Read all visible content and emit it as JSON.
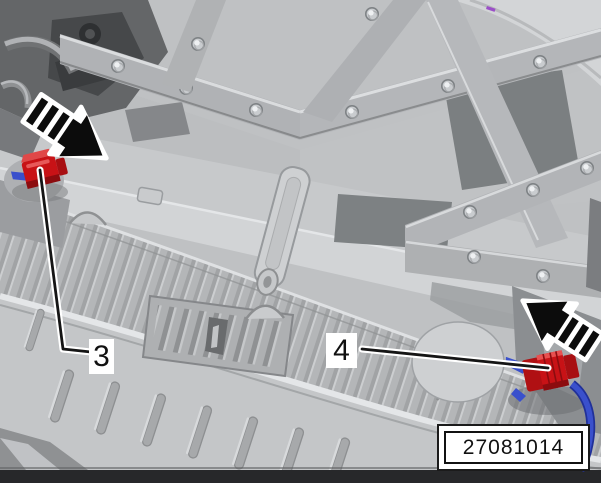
{
  "figure": {
    "callouts": [
      {
        "label": "3"
      },
      {
        "label": "4"
      }
    ],
    "reference_number": "27081014",
    "icons": [
      {
        "name": "left-direction-arrow-icon",
        "meaning": "striped arrow pointing down-right at left connector"
      },
      {
        "name": "right-direction-arrow-icon",
        "meaning": "striped arrow pointing up-left at right connector"
      }
    ],
    "colors": {
      "connector_red": "#c81216",
      "connector_red_dark": "#8c0c0f",
      "wire_blue": "#3a50cc",
      "arrow_fill": "#0c0c0c",
      "arrow_outline": "#ffffff",
      "label_background": "#ffffff",
      "label_text": "#111111",
      "background_gray": "#bfc1c3",
      "bottom_band": "#27282a"
    }
  }
}
